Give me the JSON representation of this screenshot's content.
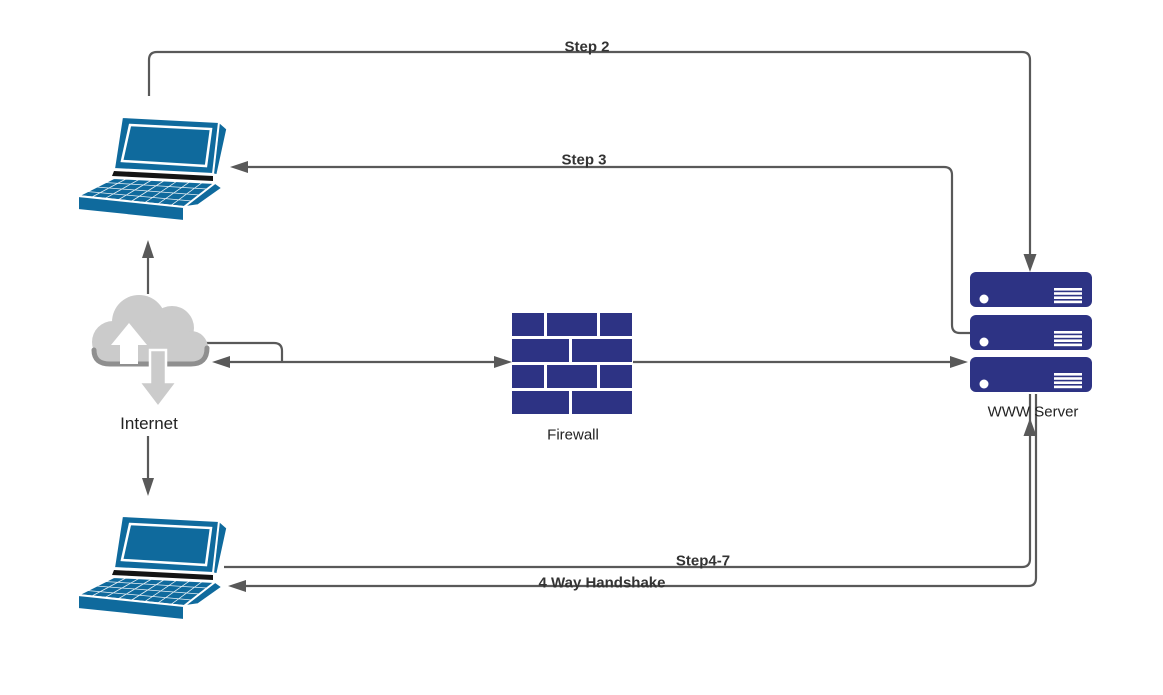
{
  "diagram": {
    "type": "network-flow-diagram",
    "background": "#ffffff",
    "colors": {
      "connector": "#595959",
      "node_navy": "#2d3384",
      "laptop_blue": "#0f6a9d",
      "cloud_gray": "#cbcbcb",
      "cloud_shadow": "#8f8f8f",
      "label_text": "#2e2e2e"
    },
    "nodes": [
      {
        "id": "laptop-top",
        "type": "laptop-icon",
        "label": ""
      },
      {
        "id": "internet",
        "type": "cloud-icon",
        "label": "Internet"
      },
      {
        "id": "firewall",
        "type": "brick-wall-icon",
        "label": "Firewall"
      },
      {
        "id": "www-server",
        "type": "server-stack-icon",
        "label": "WWW Server"
      },
      {
        "id": "laptop-bottom",
        "type": "laptop-icon",
        "label": ""
      }
    ],
    "connectors": [
      {
        "id": "step2",
        "label": "Step 2",
        "from": "laptop-top",
        "to": "www-server",
        "arrow": "to"
      },
      {
        "id": "step3",
        "label": "Step 3",
        "from": "www-server",
        "to": "laptop-top",
        "arrow": "to"
      },
      {
        "id": "cloud-to-laptop-top",
        "label": "",
        "from": "internet",
        "to": "laptop-top",
        "arrow": "to"
      },
      {
        "id": "cloud-to-laptop-bottom",
        "label": "",
        "from": "internet",
        "to": "laptop-bottom",
        "arrow": "to"
      },
      {
        "id": "cloud-firewall",
        "label": "",
        "from": "internet",
        "to": "firewall",
        "arrow": "both"
      },
      {
        "id": "firewall-server",
        "label": "",
        "from": "firewall",
        "to": "www-server",
        "arrow": "to"
      },
      {
        "id": "step4-7",
        "label": "Step4-7",
        "from": "laptop-bottom",
        "to": "www-server",
        "arrow": "to"
      },
      {
        "id": "handshake",
        "label": "4 Way Handshake",
        "from": "www-server",
        "to": "laptop-bottom",
        "arrow": "to"
      }
    ]
  }
}
